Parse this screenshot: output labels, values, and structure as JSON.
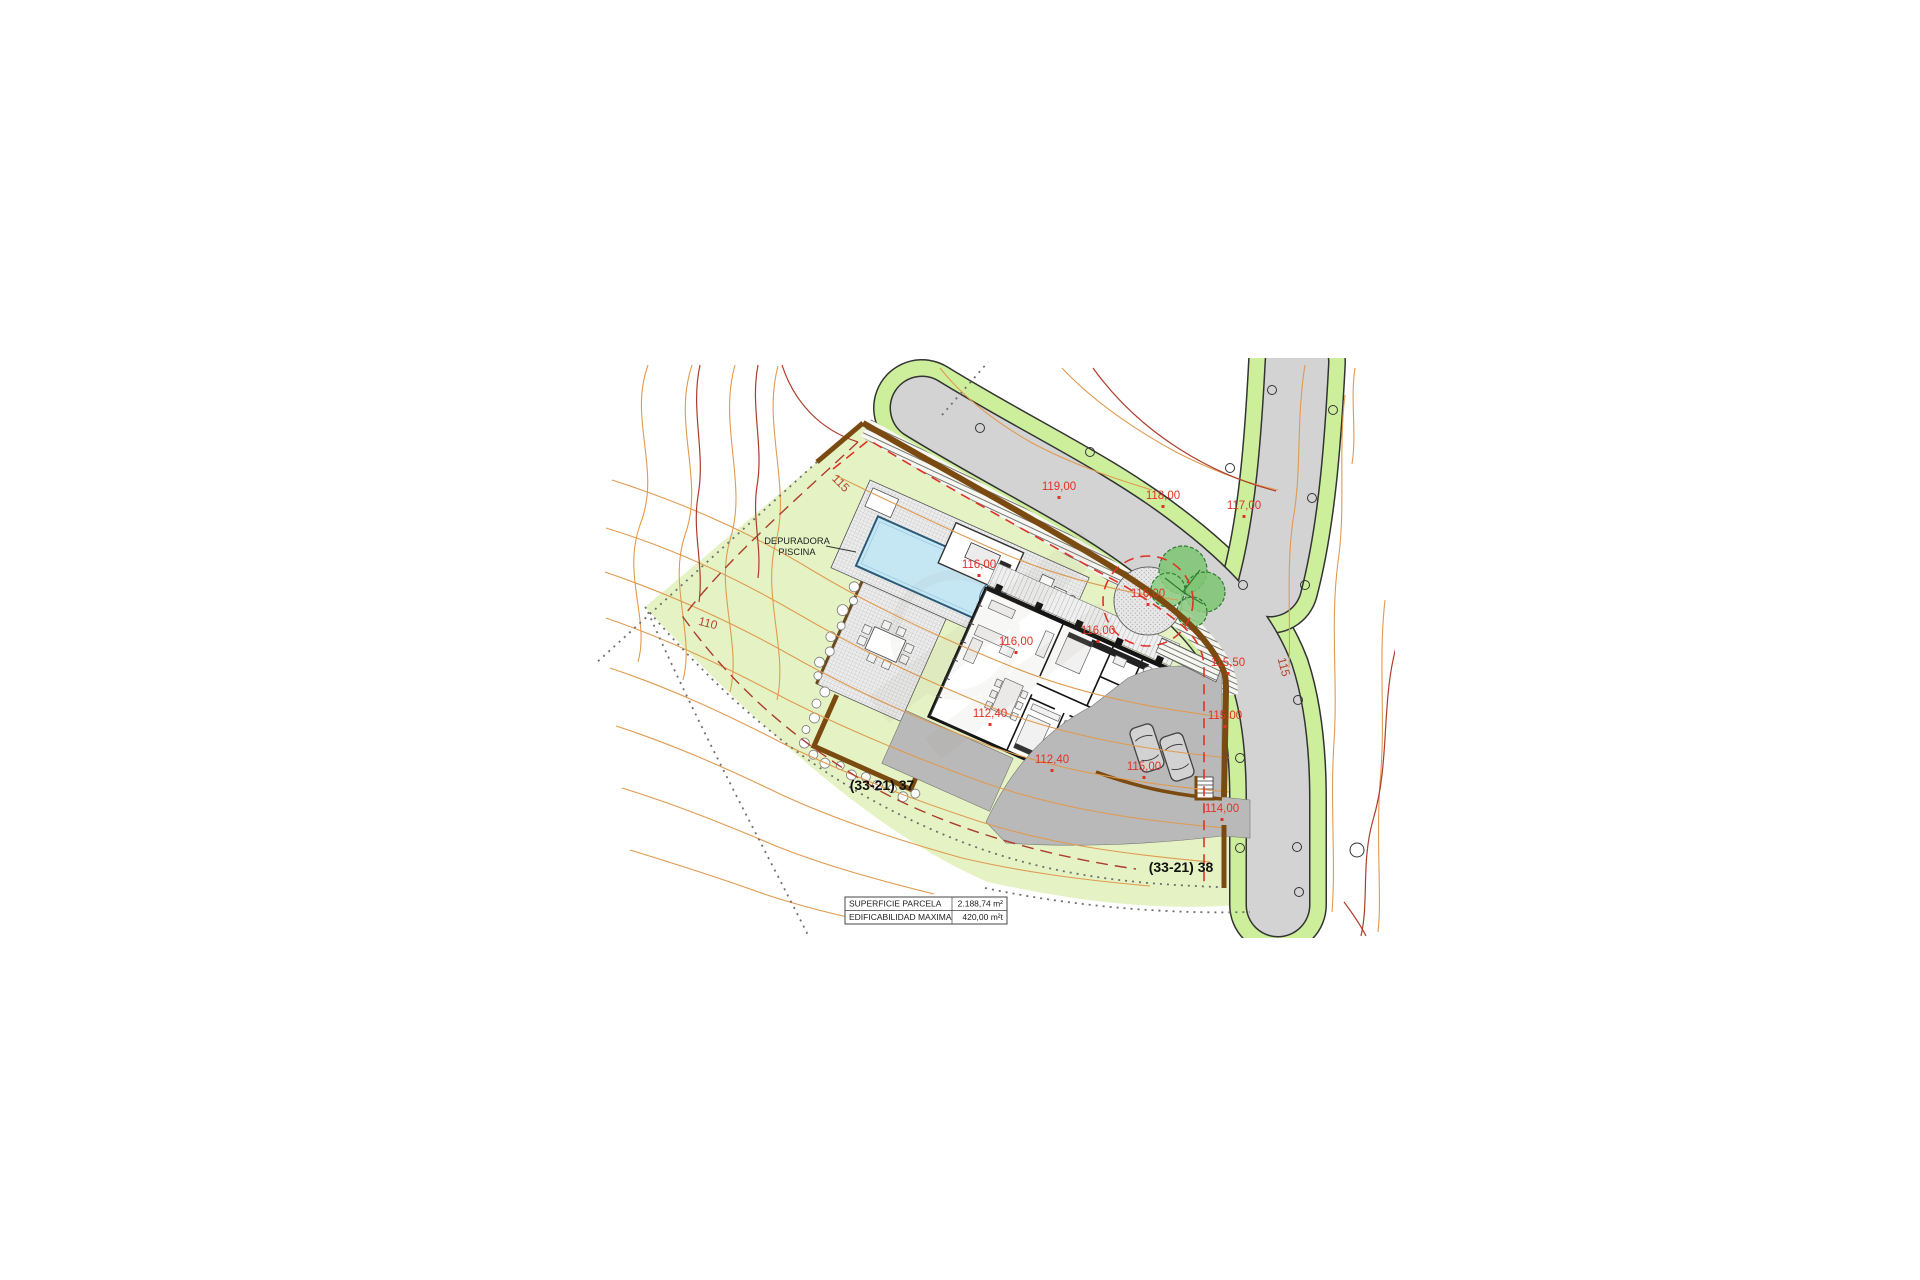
{
  "drawing": {
    "spot_elevations": [
      {
        "text": "119,00"
      },
      {
        "text": "118,00"
      },
      {
        "text": "117,00"
      },
      {
        "text": "116,00"
      },
      {
        "text": "116,00"
      },
      {
        "text": "116,00"
      },
      {
        "text": "116,00"
      },
      {
        "text": "115,50"
      },
      {
        "text": "115,00"
      },
      {
        "text": "115,00"
      },
      {
        "text": "112,40"
      },
      {
        "text": "112,40"
      },
      {
        "text": "114,00"
      }
    ],
    "contour_labels": [
      {
        "text": "115"
      },
      {
        "text": "110"
      },
      {
        "text": "115"
      }
    ],
    "parcel_ids": [
      {
        "text": "(33-21) 37"
      },
      {
        "text": "(33-21) 38"
      }
    ],
    "annotation": {
      "line1": "DEPURADORA",
      "line2": "PISCINA"
    }
  },
  "info_table": {
    "rows": [
      {
        "label": "SUPERFICIE PARCELA",
        "value": "2.188,74 m²"
      },
      {
        "label": "EDIFICABILIDAD MAXIMA",
        "value": "420,00 m²t"
      }
    ]
  },
  "colors": {
    "parcel-green": "#e5f3c4",
    "verge-green": "#cdef9c",
    "road-gray": "#d3d3d3",
    "drive-gray": "#b9b9b9",
    "boundary-brown": "#7a4a10",
    "contour-orange": "#e09a50",
    "contour-dark": "#ad3c2c",
    "label-red": "#e03226",
    "pool-blue": "#c5e7f4"
  }
}
